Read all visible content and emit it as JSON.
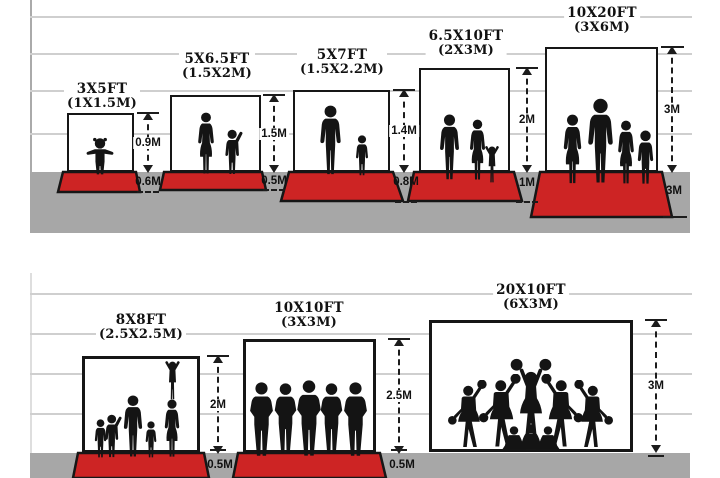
{
  "colors": {
    "carpet_red": "#cd2424",
    "ground_gray": "#a7a7a7",
    "guide_line_gray": "#cfcfcf",
    "ink": "#161616"
  },
  "panels": [
    {
      "size_ft": "3X5FT",
      "size_m": "(1X1.5M)",
      "height_label": "0.9M",
      "floor_label": "0.6M"
    },
    {
      "size_ft": "5X6.5FT",
      "size_m": "(1.5X2M)",
      "height_label": "1.5M",
      "floor_label": "0.5M"
    },
    {
      "size_ft": "5X7FT",
      "size_m": "(1.5X2.2M)",
      "height_label": "1.4M",
      "floor_label": "0.8M"
    },
    {
      "size_ft": "6.5X10FT",
      "size_m": "(2X3M)",
      "height_label": "2M",
      "floor_label": "1M"
    },
    {
      "size_ft": "10X20FT",
      "size_m": "(3X6M)",
      "height_label": "3M",
      "floor_label": "3M"
    },
    {
      "size_ft": "8X8FT",
      "size_m": "(2.5X2.5M)",
      "height_label": "2M",
      "floor_label": "0.5M"
    },
    {
      "size_ft": "10X10FT",
      "size_m": "(3X3M)",
      "height_label": "2.5M",
      "floor_label": "0.5M"
    },
    {
      "size_ft": "20X10FT",
      "size_m": "(6X3M)",
      "height_label": "3M",
      "floor_label": ""
    }
  ]
}
